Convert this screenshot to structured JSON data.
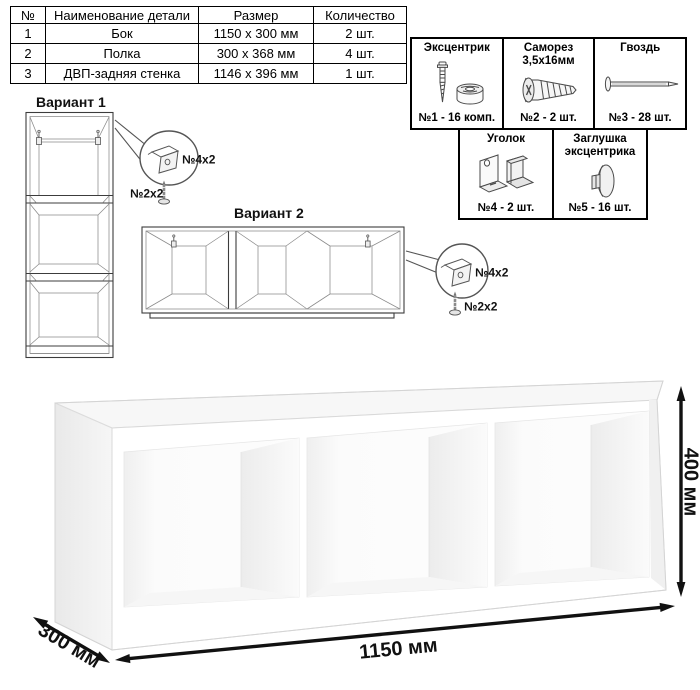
{
  "parts_table": {
    "headers": [
      "№",
      "Наименование детали",
      "Размер",
      "Количество"
    ],
    "rows": [
      {
        "num": "1",
        "name": "Бок",
        "size": "1150 x 300 мм",
        "qty": "2 шт."
      },
      {
        "num": "2",
        "name": "Полка",
        "size": "300 x 368 мм",
        "qty": "4 шт."
      },
      {
        "num": "3",
        "name": "ДВП-задняя стенка",
        "size": "1146 x 396 мм",
        "qty": "1 шт."
      }
    ]
  },
  "hardware": {
    "items": [
      {
        "title": "Эксцентрик",
        "count": "№1 - 16 комп.",
        "icon": "cam-lock-icon"
      },
      {
        "title": "Саморез 3,5х16мм",
        "count": "№2 - 2 шт.",
        "icon": "screw-icon"
      },
      {
        "title": "Гвоздь",
        "count": "№3 - 28 шт.",
        "icon": "nail-icon"
      },
      {
        "title": "Уголок",
        "count": "№4 - 2 шт.",
        "icon": "corner-bracket-icon"
      },
      {
        "title": "Заглушка эксцентрика",
        "count": "№5 - 16 шт.",
        "icon": "cam-cap-icon"
      }
    ]
  },
  "variant1": {
    "label": "Вариант 1",
    "callout": {
      "bracket_label": "№4х2",
      "screw_label": "№2х2"
    }
  },
  "variant2": {
    "label": "Вариант 2",
    "callout": {
      "bracket_label": "№4х2",
      "screw_label": "№2х2"
    }
  },
  "dimensions": {
    "width": "1150 мм",
    "height": "400 мм",
    "depth": "300 мм"
  },
  "colors": {
    "line": "#3c3c3c",
    "thin_line": "#8a8a8a",
    "arrow": "#111111",
    "table_border": "#000000",
    "background": "#ffffff"
  }
}
